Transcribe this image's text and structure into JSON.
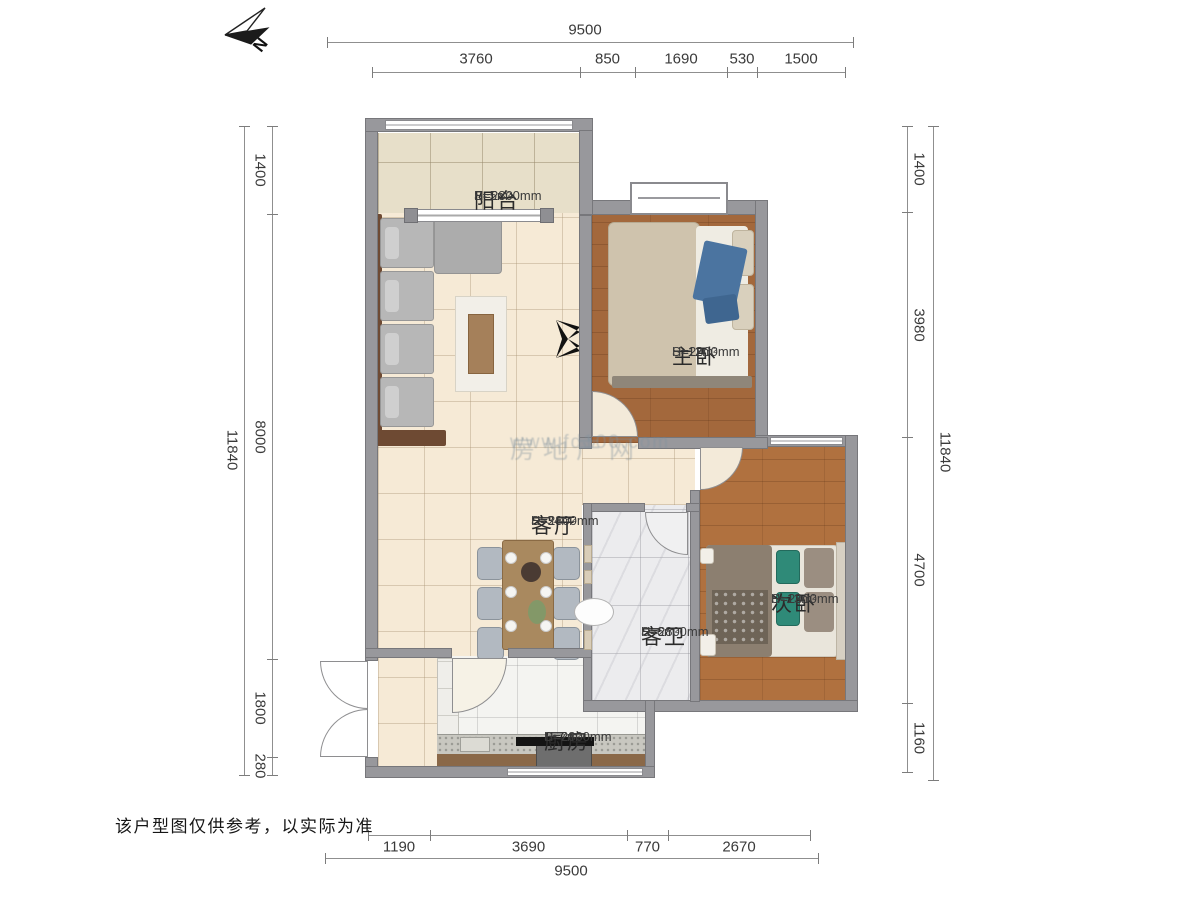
{
  "meta": {
    "disclaimer": "该户型图仅供参考，以实际为准",
    "north_label": "N"
  },
  "watermark": {
    "line1": "房地产网",
    "line2": "www.fd100.com"
  },
  "rooms": [
    {
      "id": "balcony",
      "name": "阳台",
      "height": "H=2800mm",
      "area": "S≈5m²"
    },
    {
      "id": "master",
      "name": "主卧",
      "height": "H=2800mm",
      "area": "S≈12m²"
    },
    {
      "id": "living",
      "name": "客厅",
      "height": "H=2800mm",
      "area": "S≈34m²"
    },
    {
      "id": "bath",
      "name": "客卫",
      "height": "H=2800mm",
      "area": "S≈6m²"
    },
    {
      "id": "second",
      "name": "次卧",
      "height": "H=2800mm",
      "area": "S≈13m²"
    },
    {
      "id": "kitchen",
      "name": "厨房",
      "height": "H=2800mm",
      "area": "S≈7m²"
    }
  ],
  "dimensions": {
    "top": {
      "total": "9500",
      "segments": [
        "3760",
        "850",
        "1690",
        "530",
        "1500"
      ]
    },
    "bottom": {
      "total": "9500",
      "segments": [
        "1190",
        "3690",
        "770",
        "2670"
      ]
    },
    "left": {
      "total": "11840",
      "segments": [
        "1400",
        "8000",
        "1800",
        "280"
      ]
    },
    "right": {
      "total": "11840",
      "segments": [
        "1400",
        "3980",
        "4700",
        "1160"
      ]
    }
  }
}
